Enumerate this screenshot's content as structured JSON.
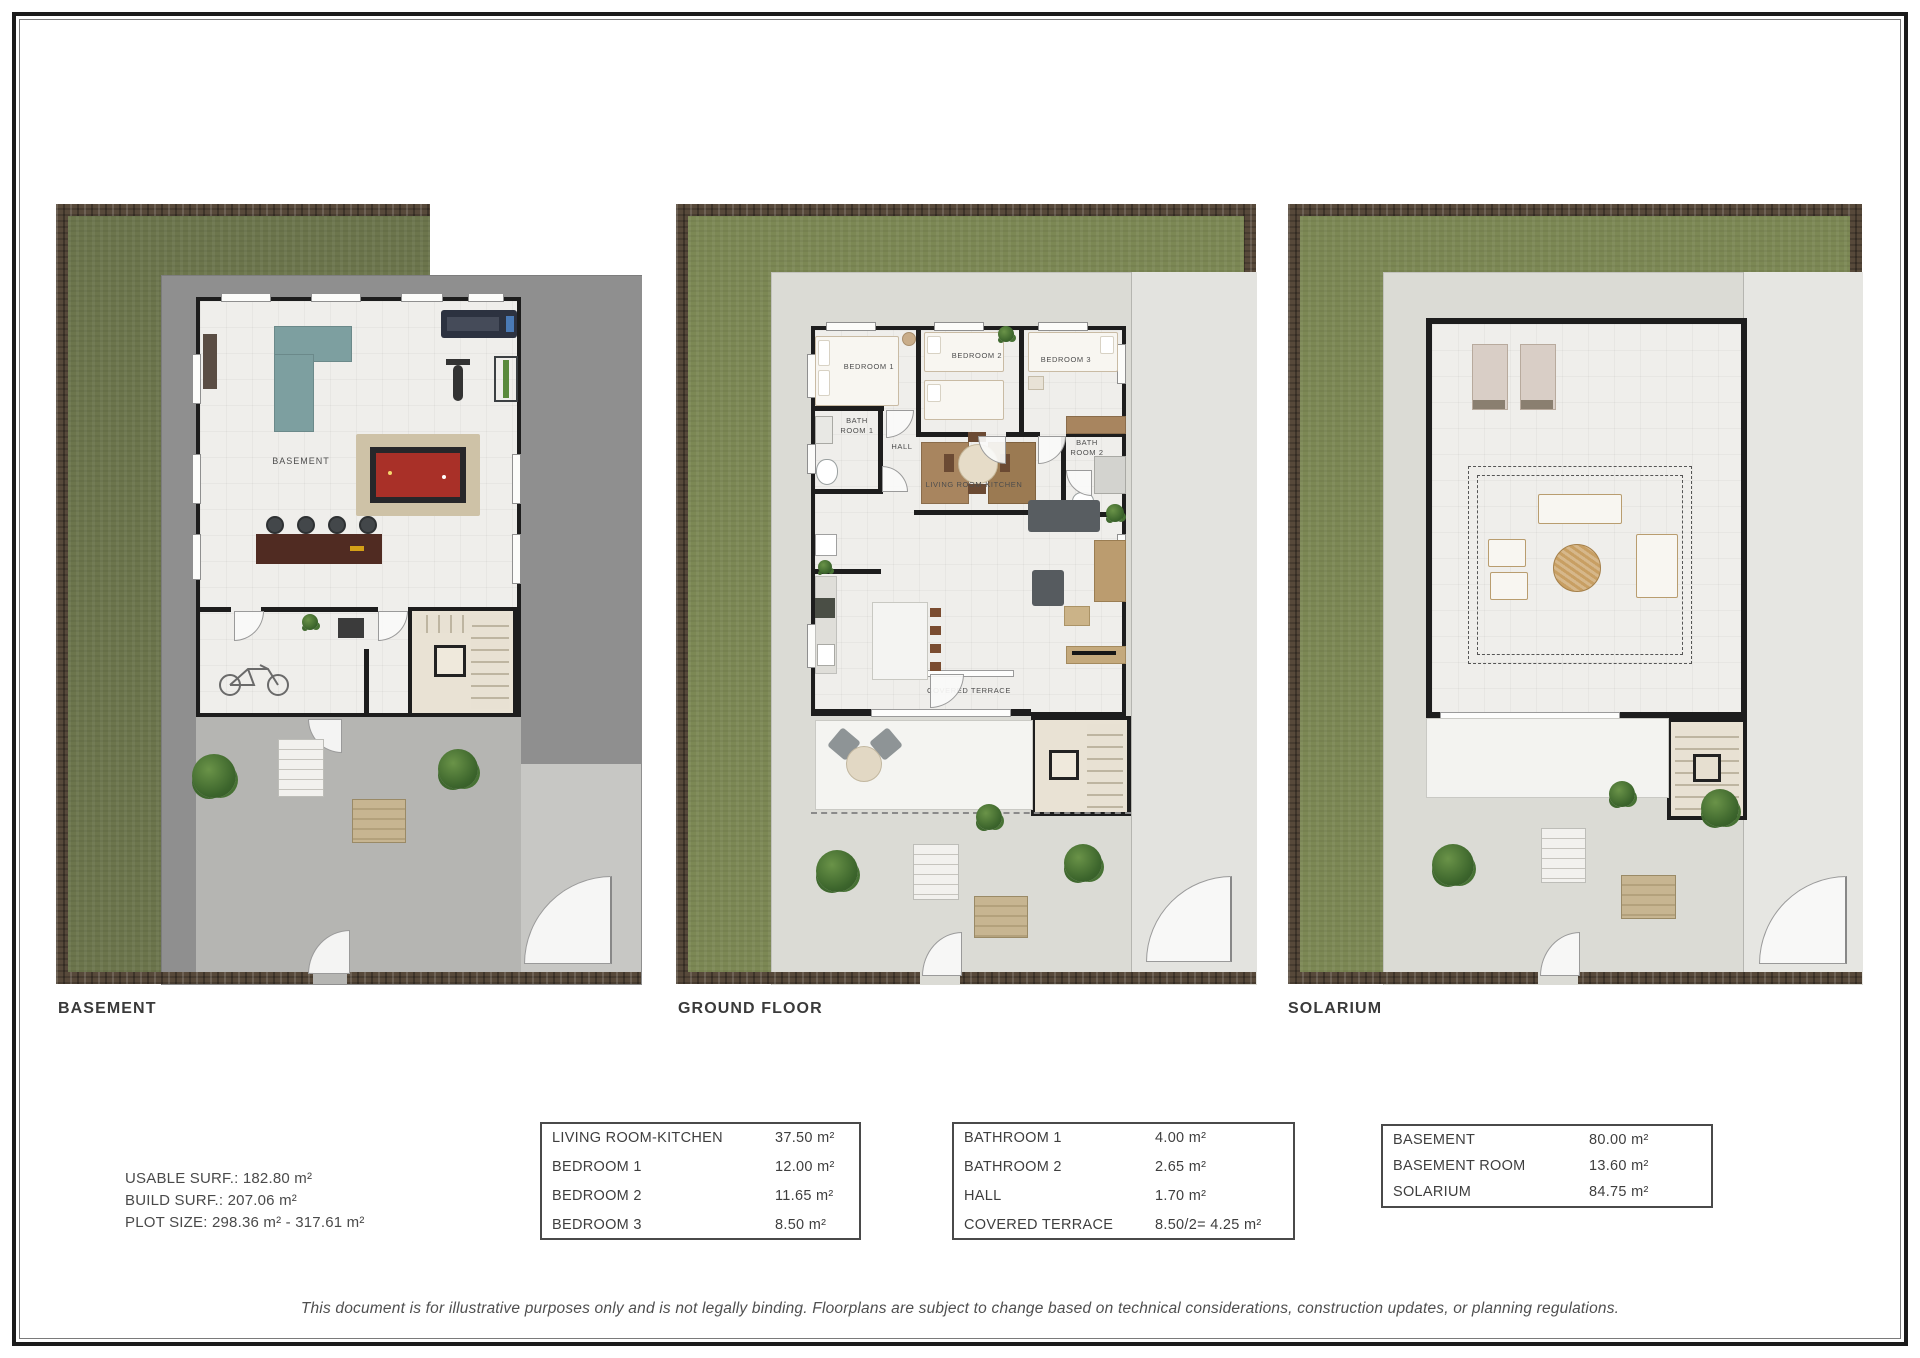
{
  "page": {
    "disclaimer": "This document is for illustrative purposes only and is not legally binding. Floorplans are subject to change based on technical considerations, construction updates, or planning regulations."
  },
  "plans": {
    "basement": {
      "caption": "BASEMENT",
      "rooms": {
        "basement": "BASEMENT"
      }
    },
    "ground_floor": {
      "caption": "GROUND FLOOR",
      "rooms": {
        "bedroom1": "BEDROOM 1",
        "bedroom2": "BEDROOM 2",
        "bedroom3": "BEDROOM 3",
        "hall": "HALL",
        "bathroom1": "BATH ROOM 1",
        "bathroom2": "BATH ROOM 2",
        "living_kitchen": "LIVING ROOM-KITCHEN",
        "covered_terrace": "COVERED TERRACE"
      }
    },
    "solarium": {
      "caption": "SOLARIUM"
    }
  },
  "summary": {
    "usable_surface": "USABLE SURF.: 182.80 m²",
    "build_surface": "BUILD SURF.: 207.06 m²",
    "plot_size": "PLOT SIZE: 298.36 m² - 317.61 m²"
  },
  "area_tables": [
    {
      "rows": [
        {
          "label": "LIVING ROOM-KITCHEN",
          "value": "37.50 m²"
        },
        {
          "label": "BEDROOM 1",
          "value": "12.00 m²"
        },
        {
          "label": "BEDROOM 2",
          "value": "11.65 m²"
        },
        {
          "label": "BEDROOM 3",
          "value": "8.50 m²"
        }
      ]
    },
    {
      "rows": [
        {
          "label": "BATHROOM 1",
          "value": "4.00 m²"
        },
        {
          "label": "BATHROOM 2",
          "value": "2.65 m²"
        },
        {
          "label": "HALL",
          "value": "1.70 m²"
        },
        {
          "label": "COVERED TERRACE",
          "value": "8.50/2= 4.25 m²"
        }
      ]
    },
    {
      "rows": [
        {
          "label": "BASEMENT",
          "value": "80.00 m²"
        },
        {
          "label": "BASEMENT ROOM",
          "value": "13.60 m²"
        },
        {
          "label": "SOLARIUM",
          "value": "84.75 m²"
        }
      ]
    }
  ],
  "colors": {
    "grass": "#7c8854",
    "grass_dark": "#6c754c",
    "soil": "#57493a",
    "wall": "#1d1d1d",
    "concrete_dark": "#8f8f8f",
    "concrete_light": "#dbdbd5",
    "accent_red": "#a93028",
    "accent_teal": "#7d9fa0"
  }
}
